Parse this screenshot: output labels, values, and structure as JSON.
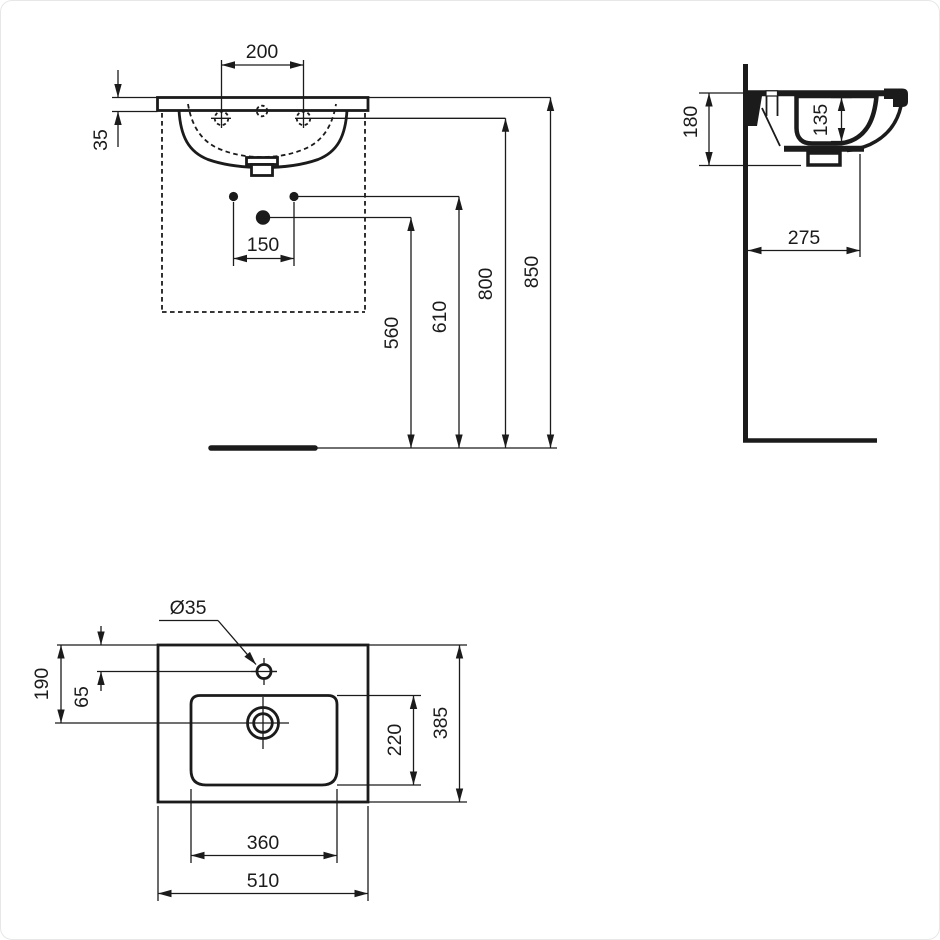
{
  "drawing": {
    "background": "#ffffff",
    "ink": "#1b1b1b",
    "front": {
      "tap_spacing": "200",
      "rim_to_tapline": "35",
      "fixing_spacing": "150",
      "outlet_height": "560",
      "fixing_height": "610",
      "tapline_height": "800",
      "rim_height": "850"
    },
    "side": {
      "body_height": "180",
      "bowl_depth": "135",
      "wall_to_front": "275"
    },
    "top": {
      "tap_hole_diameter": "Ø35",
      "rear_to_outlet": "190",
      "rear_to_tap": "65",
      "bowl_depth": "220",
      "overall_depth": "385",
      "bowl_width": "360",
      "overall_width": "510"
    }
  }
}
